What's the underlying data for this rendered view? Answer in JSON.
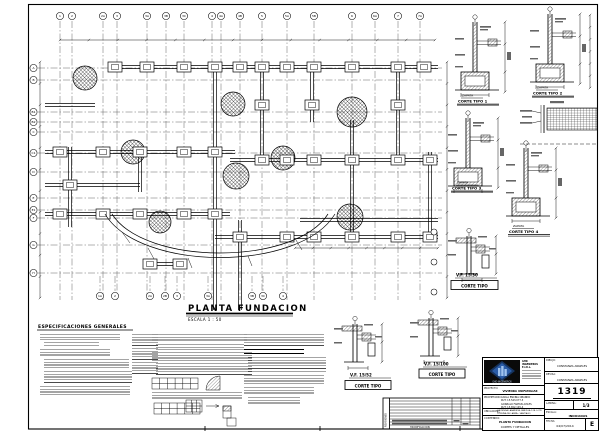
{
  "sheet": {
    "title": "PLANTA FUNDACION",
    "scale": "ESCALA 1 : 50",
    "specs_heading": "ESPECIFICACIONES GENERALES"
  },
  "grid": {
    "top": [
      "1",
      "2",
      "2A",
      "3",
      "3A",
      "3B",
      "3C",
      "4",
      "4A",
      "4B",
      "5",
      "5A",
      "5B",
      "6",
      "6A",
      "7",
      "7A"
    ],
    "left": [
      "A",
      "B",
      "B1",
      "B2",
      "C",
      "C1",
      "D",
      "E",
      "E1",
      "F",
      "G",
      "H"
    ],
    "bottom": [
      "1A",
      "2",
      "2A",
      "2B",
      "3",
      "3A",
      "3B",
      "3C",
      "4"
    ]
  },
  "details": [
    {
      "t": "ZAPATA",
      "s": "CORTE TIPO 1"
    },
    {
      "t": "ZAPATA",
      "s": "CORTE TIPO 2"
    },
    {
      "t": "ZAPATA",
      "s": "CORTE TIPO 3"
    },
    {
      "t": "ZAPATA",
      "s": "CORTE TIPO 4"
    },
    {
      "t": "V.F. 15/30",
      "s": "CORTE TIPO"
    },
    {
      "t": "V.F. 15/52",
      "s": "CORTE TIPO"
    },
    {
      "t": "V.F. 15/100",
      "s": "CORTE TIPO"
    }
  ],
  "titleblock": {
    "company_name": "GHD INGENIEROS E.I.R.L.",
    "logo_caption": "GHD INGENIEROS",
    "proyecto_label": "PROYECTO:",
    "proyecto": "VIVIENDA UNIFAMILIAR",
    "propietario_label": "PROPIETARIO:",
    "propietario_l1": "CARLA ENCINA OBANDO",
    "propietario_l2": "RUT: 15.543.077-5",
    "propietario_l3": "GONZALO FARFAN AVILES",
    "propietario_l4": "RUT: 15.652.145-4",
    "ubicacion_label": "UBICACION:",
    "ubicacion_l1": "HACIENDA LARAPINTA, PARCELA 128, LOTE 23",
    "ubicacion_l2": "COMUNA DE LAMPA - SANTIAGO",
    "contenido_label": "CONTENIDO:",
    "contenido_l1": "PLANTA FUNDACION",
    "contenido_l2": "CORTES Y DETALLES",
    "dibujo_label": "DIBUJO:",
    "dibujo": "CONSTANZA ANGELES",
    "revisa_label": "REVISA:",
    "revisa": "CONSTANZA ANGELES",
    "numero": "1319",
    "lamina_label": "LAMINA:",
    "lamina": "1/3",
    "escala_label": "ESCALA:",
    "escala": "INDICADAS",
    "fecha_label": "FECHA:",
    "fecha": "04/07/2014",
    "rev_letter": "E"
  },
  "revisions": {
    "side_label": "REVISIONES",
    "footer": "MODIFICACION"
  }
}
